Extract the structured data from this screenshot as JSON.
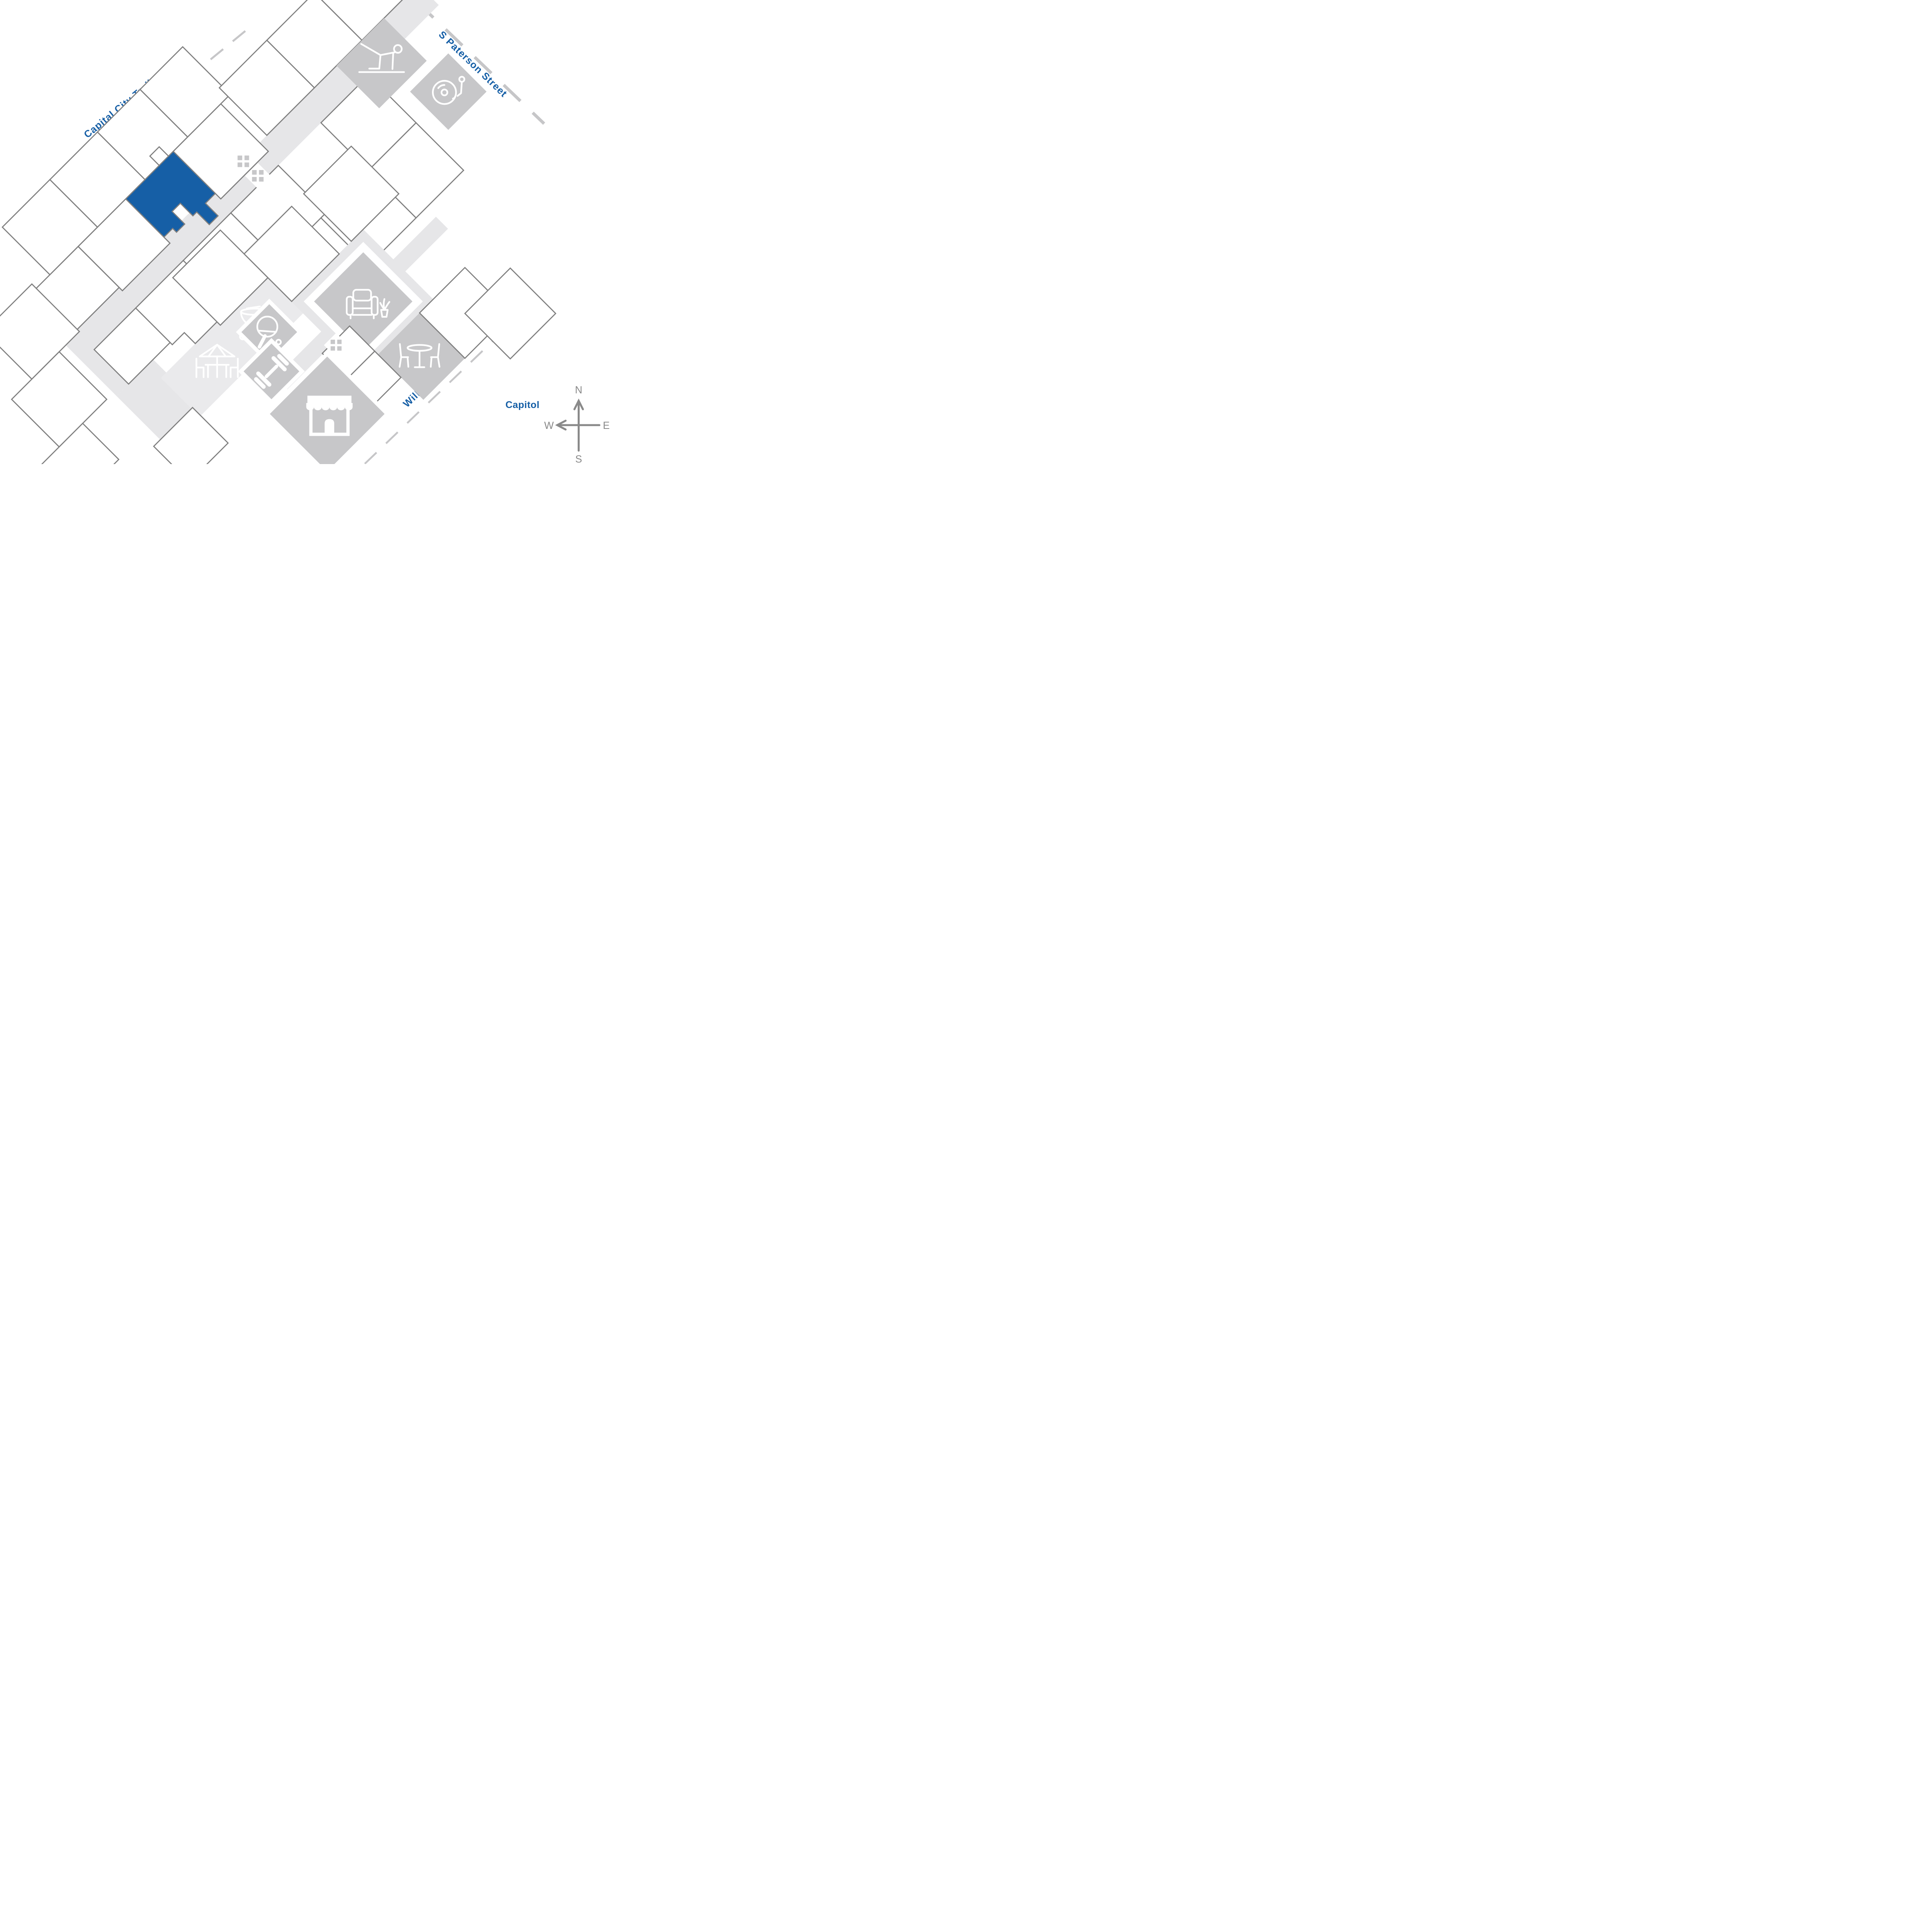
{
  "map": {
    "title": "community site plan",
    "streets": [
      {
        "id": "capital-city-trail",
        "name": "Capital City Trail"
      },
      {
        "id": "s-paterson-street",
        "name": "S Paterson Street"
      },
      {
        "id": "williamson-street",
        "name": "Williamson Street"
      }
    ],
    "landmarks": [
      {
        "id": "capitol",
        "name": "Capitol"
      }
    ],
    "compass": {
      "north": "N",
      "east": "E",
      "south": "S",
      "west": "W"
    },
    "highlighted_unit": {
      "description": "selected residence footprint",
      "color": "#165fa6"
    },
    "amenities": [
      {
        "id": "fitness-room",
        "icon": "yoga-person-icon"
      },
      {
        "id": "music-room",
        "icon": "record-player-icon"
      },
      {
        "id": "elevator-north-1",
        "icon": "elevator-x-icon"
      },
      {
        "id": "elevator-north-2",
        "icon": "elevator-x-icon"
      },
      {
        "id": "elevator-south",
        "icon": "elevator-x-icon"
      },
      {
        "id": "bbq-patio",
        "icon": "bbq-grill-icon"
      },
      {
        "id": "outdoor-seating",
        "icon": "patio-umbrella-table-icon"
      },
      {
        "id": "game-room",
        "icon": "ping-pong-icon"
      },
      {
        "id": "gym",
        "icon": "dumbbell-icon"
      },
      {
        "id": "store",
        "icon": "storefront-icon"
      },
      {
        "id": "lounge",
        "icon": "armchair-plant-icon"
      },
      {
        "id": "dining-area",
        "icon": "dining-table-icon"
      }
    ],
    "colors": {
      "highlight": "#165fa6",
      "street_label": "#165fa6",
      "unit_outline": "#7f7f7f",
      "amenity_fill": "#c7c7c9",
      "corridor_fill": "#e6e6e8",
      "patio_fill": "#eaeaec",
      "dash_line": "#c6c6c8",
      "compass": "#8a8a8a",
      "background": "#ffffff"
    }
  }
}
